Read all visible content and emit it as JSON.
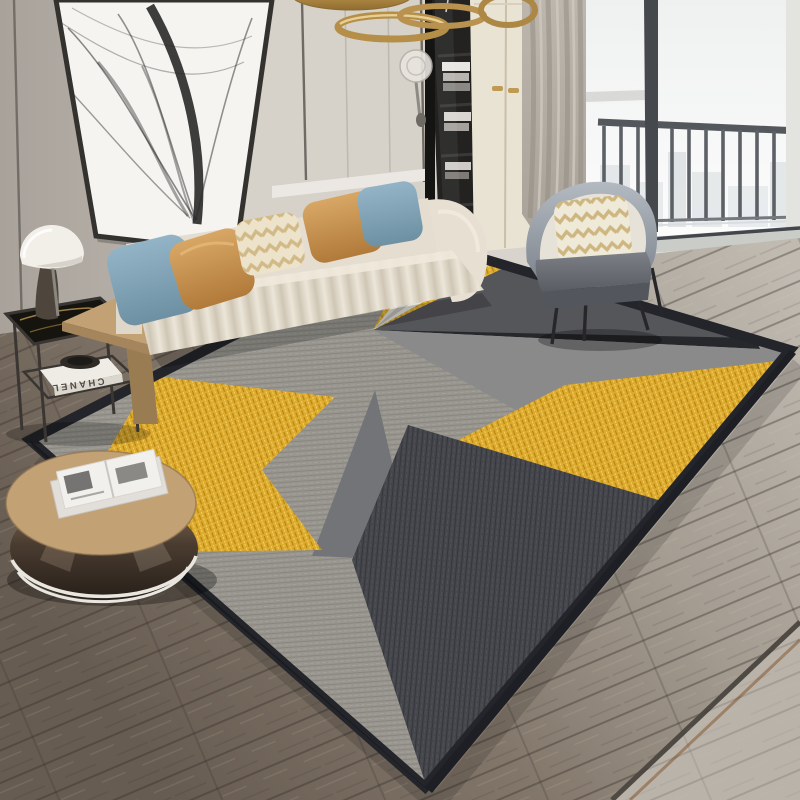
{
  "scene": {
    "description": "Modern living room product photo showcasing a geometric area rug with yellow-gold, gray and charcoal triangles on wood flooring, beige channel-tufted sofa with blue and caramel pillows, gray barrel armchair, black-and-white abstract wall art, gold ring pendant lights, wardrobe, bookshelf and a floor-to-ceiling balcony window with city view",
    "objects": {
      "wall_art": "abstract black thread line art, leaning framed canvas",
      "pendant": "brass ring pendant lights",
      "sconce": "glass globe wall lamp",
      "bookshelf": "dark open bookshelf",
      "wardrobe": "cream wardrobe with gold handles",
      "curtain": "gray-taupe curtain",
      "window": "floor-to-ceiling window with balcony railing and hazy city view",
      "sofa": "beige channel-tufted sofa",
      "armchair": "gray barrel armchair with chevron pillow",
      "side_table": "black metal side table with marble top",
      "lamp": "white dome table lamp",
      "c_table": "tan wood C-shaped sofa table",
      "coffee_table": "round wood-top drum coffee table with mirrored band",
      "rug": "geometric triangle rug in gold, gray, charcoal",
      "floor": "wood plank floor, lighter near window"
    }
  },
  "text": {
    "book_spine": "CHANEL"
  },
  "colors": {
    "wall": "#b6b0a9",
    "panel": "#d6d1c9",
    "art_canvas": "#f5f4f1",
    "bookshelf": "#232220",
    "wardrobe": "#e9e3d4",
    "handle_gold": "#c09a52",
    "curtain": "#b5afa6",
    "sky": "#eef1f1",
    "railing": "#5d6166",
    "frame_dark": "#3b3e42",
    "pendant_gold": "#b58e48",
    "sofa": "#e4ddd0",
    "pillow_blue": "#86a9bd",
    "pillow_caramel": "#cc9a5c",
    "pillow_cream": "#ede3cb",
    "chevron": "#c8ad72",
    "chair_shell": "#e7e2d7",
    "chair_back": "#98a0a9",
    "chair_seat": "#6e7278",
    "wood_table": "#c2a175",
    "metal_frame": "#3a3633",
    "book_white": "#efece6",
    "book_text": "#514c45",
    "lamp_shade": "#f2efe9",
    "floor_light": "#b9b3aa",
    "floor_dark": "#6e6357",
    "rug_heather": "#97958e",
    "rug_gold": "#ddab2f",
    "rug_charcoal": "#45464b",
    "rug_medium": "#8a8a8b",
    "rug_dark": "#55565a",
    "rug_black": "#27282c",
    "rug_white": "#dedcd8",
    "rug_border": "#23252a"
  }
}
